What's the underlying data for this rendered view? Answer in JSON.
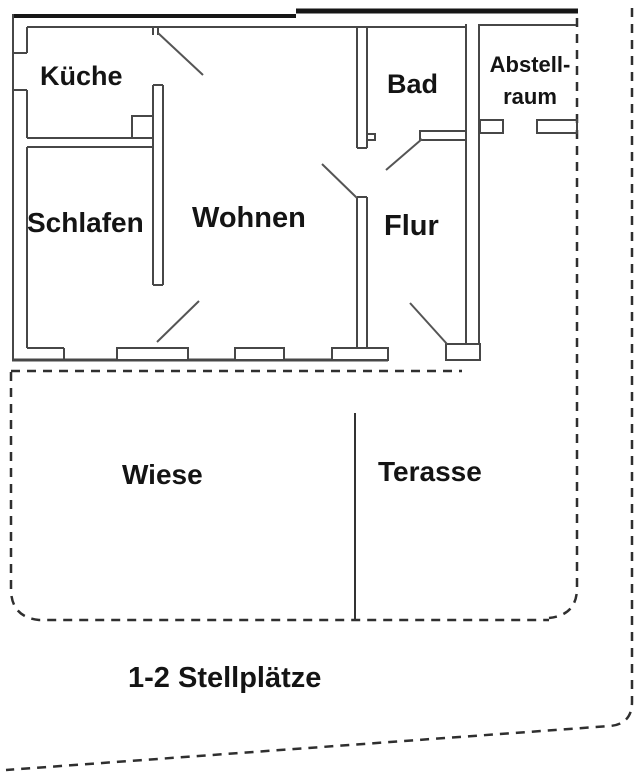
{
  "figure": {
    "type": "floor-plan",
    "colors": {
      "wall_line": "#474747",
      "thick_outline": "#161616",
      "boundary_dashed": "#2f2f2f",
      "text": "#141414",
      "background": "#ffffff"
    }
  },
  "rooms": {
    "kueche": "Küche",
    "bad": "Bad",
    "abstellraum_line1": "Abstell-",
    "abstellraum_line2": "raum",
    "schlafen": "Schlafen",
    "wohnen": "Wohnen",
    "flur": "Flur"
  },
  "outdoor": {
    "wiese": "Wiese",
    "terasse": "Terasse",
    "stellplaetze": "1-2 Stellplätze"
  }
}
